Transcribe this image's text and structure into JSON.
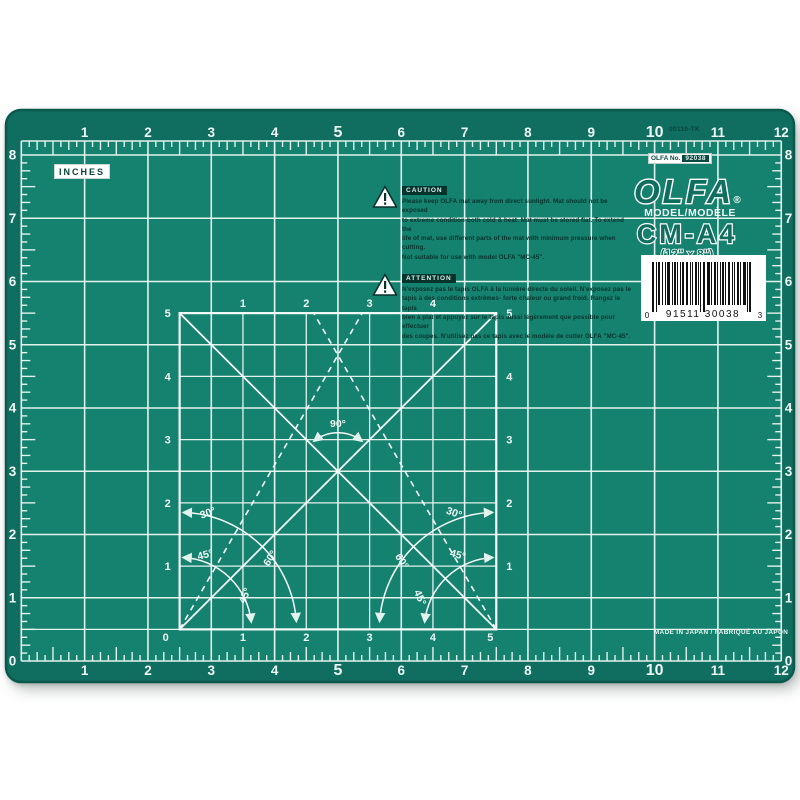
{
  "mat": {
    "inches_label": "INCHES",
    "part_code": "00110-TK",
    "stock_label": {
      "prefix": "OLFA No.",
      "number": "92038"
    },
    "brand": {
      "name": "OLFA",
      "registered": "®"
    },
    "model": {
      "label": "MODEL/MODÈLE",
      "value": "CM-A4",
      "size": "(12\" x 8\")"
    },
    "barcode": {
      "lead": "0",
      "value": "91511 30038",
      "check": "3"
    },
    "caution": {
      "header": "CAUTION",
      "body": [
        "Please keep OLFA mat away from direct sunlight. Mat should not be exposed",
        "to extreme condition-both cold & heat. Mat must be stored flat. To extend the",
        "life of mat, use different parts of the mat with minimum pressure when cutting.",
        "Not suitable for use with model OLFA \"MC-45\"."
      ]
    },
    "attention": {
      "header": "ATTENTION",
      "body": [
        "N'exposez pas le tapis OLFA à la lumière directe du soleil. N'exposez pas le",
        "tapis à des conditions extrêmes- forte chaleur ou grand froid. Rangez le tapis",
        "bien à plat et appuyez sur le tapis aussi légèrement que possible pour effectuer",
        "des coupes. N'utilisez pas ce tapis avec le modèle de cutter OLFA \"MC-45\"."
      ]
    },
    "made_in": "MADE IN JAPAN / FABRIQUÉ AU JAPON",
    "rulers": {
      "top": [
        "1",
        "2",
        "3",
        "4",
        "5",
        "6",
        "7",
        "8",
        "9",
        "10",
        "11",
        "12"
      ],
      "bottom": [
        "1",
        "2",
        "3",
        "4",
        "5",
        "6",
        "7",
        "8",
        "9",
        "10",
        "11",
        "12"
      ],
      "left": [
        "8",
        "7",
        "6",
        "5",
        "4",
        "3",
        "2",
        "1",
        "0"
      ],
      "right": [
        "8",
        "7",
        "6",
        "5",
        "4",
        "3",
        "2",
        "1",
        "0"
      ],
      "emphasized": [
        "5",
        "10"
      ]
    },
    "center_square": {
      "top": [
        "1",
        "2",
        "3",
        "4"
      ],
      "bottom": [
        "0",
        "1",
        "2",
        "3",
        "4",
        "5"
      ],
      "left": [
        "5",
        "4",
        "3",
        "2",
        "1"
      ],
      "right": [
        "5",
        "4",
        "3",
        "2",
        "1"
      ],
      "angles": {
        "ninety": "90°",
        "thirty": "30°",
        "forty_five": "45°",
        "sixty": "60°"
      }
    },
    "colors": {
      "mat_base": "#0F6E5F",
      "mat_inner": "#15816F",
      "mat_edge": "#0A594C",
      "grid_line": "#E2F2ED",
      "ink_dark": "#06332C",
      "label_bg": "#FFFFFF"
    }
  }
}
